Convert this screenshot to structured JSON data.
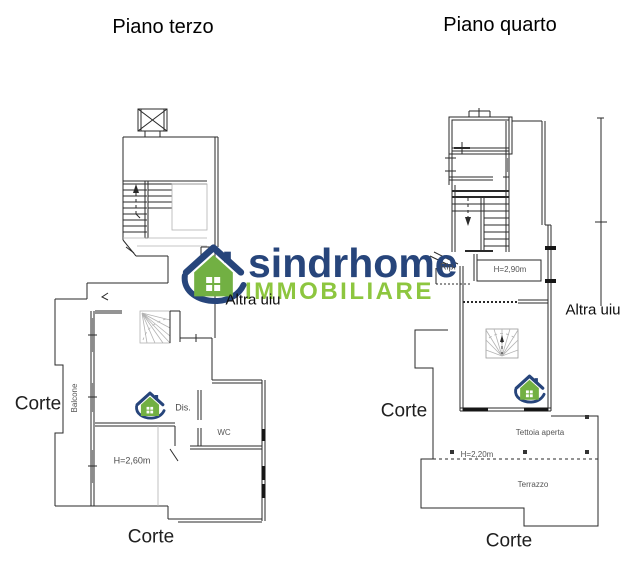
{
  "plans": {
    "terzo": {
      "title": "Piano terzo",
      "labels": {
        "altra_uiu": "Altra uiu",
        "corte_left": "Corte",
        "corte_bottom": "Corte",
        "balcone": "Balcone",
        "dis": "Dis.",
        "wc": "WC",
        "room_height": "H=2,60m"
      }
    },
    "quarto": {
      "title": "Piano quarto",
      "labels": {
        "altra_uiu": "Altra uiu",
        "corte_left": "Corte",
        "corte_bottom": "Corte",
        "rip": "Rip.",
        "rip_height": "H=2,90m",
        "tettoia_aperta": "Tettoia aperta",
        "tettoia_height": "H=2,20m",
        "terrazzo": "Terrazzo"
      }
    }
  },
  "watermark": {
    "brand": "sindrhome",
    "tagline": "IMMOBILIARE",
    "colors": {
      "brand_blue": "#27457b",
      "tagline_green": "#8dc63f",
      "house_green": "#72b043"
    }
  }
}
